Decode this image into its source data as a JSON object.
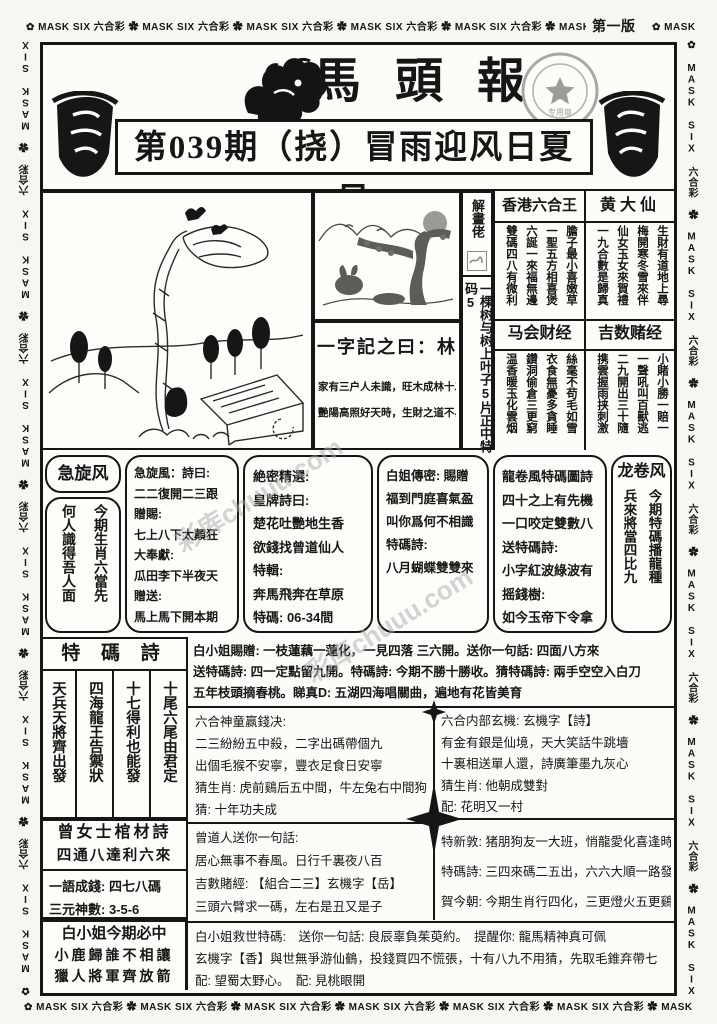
{
  "border": {
    "unit": "MASK SIX 六合彩",
    "flower": "✿",
    "edition": "第一版"
  },
  "header": {
    "title": "馬頭報",
    "headline": "第039期（挠）冒雨迎风日夏日",
    "stamp": {
      "star": "★",
      "label": "专用章"
    }
  },
  "watermark": "彩库chuuu.com",
  "strip": {
    "top": "解畫佬",
    "body": "一棵树与树上叶子5片正中特码5"
  },
  "word_box": {
    "title": "一字記之曰：林",
    "lines": [
      "家有三户人未識，旺木成林十二月",
      "艷陽高照好天時，生財之道不易尋"
    ]
  },
  "right_sections": [
    {
      "title": "香港六合王",
      "cols": [
        "膽子最小喜嫩草",
        "一聖五方相喜煲",
        "六誕一來福無邊",
        "雙碼四八有微利"
      ]
    },
    {
      "title": "黄大仙",
      "cols": [
        "生財有道地上尋",
        "梅開寒冬雪來伴",
        "仙女玉女來賀禮",
        "一九合數是歸真"
      ]
    },
    {
      "title": "马会财经",
      "cols": [
        "絲毫不苟毛如雪",
        "衣食無憂多貪睡",
        "鑽洞偷倉三更窮",
        "温香暖玉化雲烟"
      ]
    },
    {
      "title": "吉数赌经",
      "cols": [
        "小賭小勝一賠一",
        "一聲吼叫百獸逃",
        "二九開出三十隨",
        "携雲握雨挟刺激"
      ]
    }
  ],
  "jixuanfeng": {
    "title": "急旋风",
    "cols": [
      "今期生肖六當先",
      "何人識得吾人面"
    ]
  },
  "jixuanfeng_poem": {
    "lines": [
      "急旋風：詩曰:",
      "二二復開二三跟",
      "贈賜:",
      "七上八下太顛狂",
      "大奉獻:",
      "瓜田李下半夜天",
      "贈送:",
      "馬上馬下開本期"
    ]
  },
  "juemi": {
    "lines": [
      "絶密精選:",
      "皇牌詩曰:",
      "楚花吐艷地生香",
      "欲錢找曾道仙人",
      "特輯:",
      "奔馬飛奔在草原",
      "特碼: 06-34間"
    ]
  },
  "baijie": {
    "lines": [
      "白姐傳密: 賜贈",
      "福到門庭喜氣盈",
      "叫你爲何不相識",
      "",
      "特碼詩:",
      "",
      "八月蝴蝶雙雙來"
    ]
  },
  "longjuan_poem": {
    "lines": [
      "龍卷風特碼圖詩",
      "四十之上有先機",
      "一口咬定雙數八",
      "送特碼詩:",
      "小字紅波綠波有",
      "摇錢樹:",
      "如今玉帝下令拿"
    ]
  },
  "longjuanfeng": {
    "title": "龙卷风",
    "cols": [
      "今期特碼播龍種",
      "兵來將當四比九"
    ]
  },
  "tema_poem": {
    "title": "特 碼 詩",
    "cols": [
      "十尾六尾由君定",
      "十七得利也能發",
      "四海龍王告禦狀",
      "天兵天將齊出發"
    ]
  },
  "baixiaojie_gift": {
    "lines": [
      "白小姐賜贈: 一枝蓮藕一蓮化，一見四落 三六開。送你一句話: 四面八方來",
      "送特碼詩: 四一定點留九開。特碼詩: 今期不勝十勝收。猜特碼詩: 兩手空空入白刀",
      "五年枝頭摘春桃。睇真D: 五湖四海唱關曲，遍地有花皆美育"
    ]
  },
  "shentong": {
    "lines": [
      "六合神童赢錢决:",
      "二三紛紛五中殺，二字出碼帶個九",
      "出個毛猴不安寧，豐衣足食日安寧",
      "猜生肖: 虎前鷄后五中間，牛左兔右中間狗",
      "猜: 十年功夫成"
    ]
  },
  "neibu": {
    "lines": [
      "六合内部玄機: 玄機字【詩】",
      "有金有銀是仙境，天大笑話牛跳墻",
      "十裏相送單人還，詩廣筆墨九灰心",
      "猜生肖: 他朝成雙對",
      "配: 花明又一村"
    ]
  },
  "guancai": {
    "title": "曾女士棺材詩",
    "line": "四通八達利六來",
    "sub": [
      "一語成錢: 四七八碼",
      "三元神數: 3-5-6"
    ]
  },
  "zengdaoren": {
    "lines": [
      "曾道人送你一句話:",
      "居心無事不春風。日行千裏夜八百",
      "吉數賭經: 【組合二三】玄機字【岳】",
      "三頭六臂求一碼，左右是丑又是子"
    ]
  },
  "texin": {
    "lines": [
      "特新敦: 猪朋狗友一大班，悄龍愛化喜逢時",
      "特碼詩: 三四來碼二五出，六六大順一路發",
      "賀今朝: 今期生肖行四化，三更燈火五更鷄"
    ]
  },
  "bizhong": {
    "title": "白小姐今期必中",
    "lines": [
      "小鹿歸誰不相讓",
      "獵人將軍齊放箭"
    ]
  },
  "jiushi": {
    "lines": [
      "白小姐救世特碼:　送你一句話: 良辰辜負茱萸約。　提醒你: 龍馬精神真可佩",
      "玄機字【香】與世無爭游仙鶴，投錢買四不慌張，十有八九不用猜，先取毛錐弃帶七",
      "配: 望蜀太野心。　配: 見桃眼開"
    ]
  }
}
